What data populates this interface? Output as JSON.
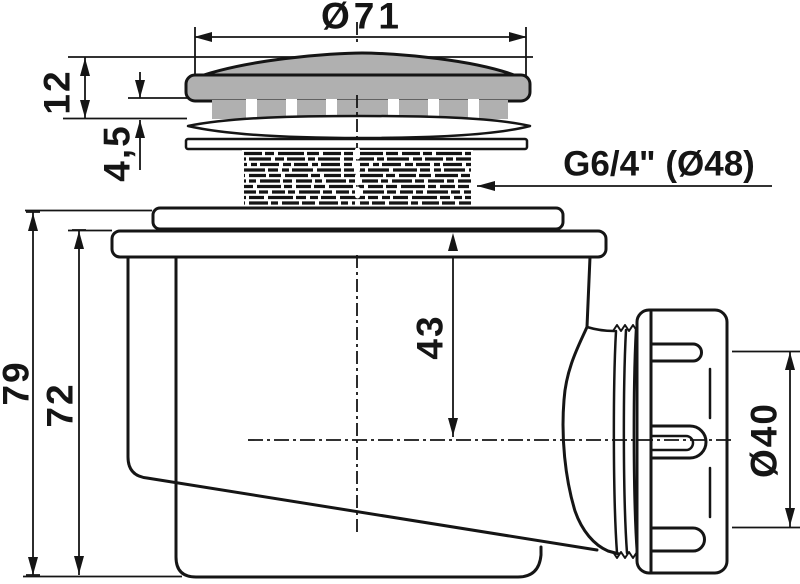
{
  "drawing_type": "shower drain trap cross-section",
  "colors": {
    "line": "#151515",
    "cap_fill": "#b0b0b0",
    "background": "#ffffff"
  },
  "dims": {
    "cap_diameter": "Ø71",
    "cap_height": "12",
    "inflow_gap": "4,5",
    "thread_spec": "G6/4\" (Ø48)",
    "flange_to_outlet_axis": "43",
    "total_height": "79",
    "body_height": "72",
    "outlet_diameter": "Ø40"
  }
}
